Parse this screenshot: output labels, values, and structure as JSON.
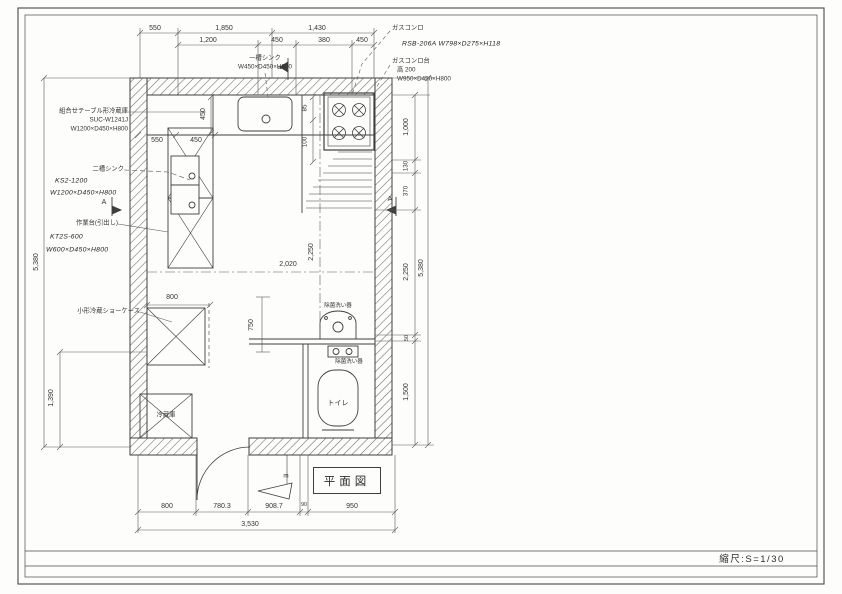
{
  "sheet": {
    "plan_title": "平面図",
    "scale_label": "縮尺:S=1/30"
  },
  "equipment": {
    "combo_fridge_table": {
      "name": "組合せテーブル形冷蔵庫",
      "model": "SUC-W1241J",
      "size": "W1200×D450×H800"
    },
    "single_sink": {
      "name": "一槽シンク",
      "size": "W450×D450×H800"
    },
    "gas_range": {
      "name": "ガスコンロ",
      "spec": "RSB-206A W798×D275×H118"
    },
    "gas_range_stand": {
      "name": "ガスコンロ台",
      "height_note": "高 200",
      "size": "W950×D450×H800"
    },
    "double_sink": {
      "name": "二槽シンク",
      "model": "KS2-1200",
      "size": "W1200×D450×H800"
    },
    "work_table": {
      "name": "作業台(引出し)",
      "model": "KT2S-600",
      "size": "W600×D450×H800"
    },
    "small_showcase": {
      "name": "小形冷蔵ショーケース"
    },
    "refrigerator": {
      "name": "冷蔵庫"
    },
    "sanitizer_upper": {
      "name": "除菌洗い器"
    },
    "sanitizer_lower": {
      "name": "除菌洗い器"
    },
    "toilet": {
      "name": "トイレ"
    }
  },
  "section_marks": {
    "top": "m",
    "bottom": "m",
    "left": "A",
    "right": "A"
  },
  "dimensions": {
    "top_row_overall": [
      "550",
      "1,850",
      "1,430"
    ],
    "top_row_detail": [
      "1,200",
      "450",
      "380",
      "450"
    ],
    "interior_top_widths": [
      "550",
      "450"
    ],
    "sink_depth": "450",
    "range_offsets": [
      "85",
      "100"
    ],
    "room_width": "2,020",
    "room_height": "2,250",
    "left_overall": "5,380",
    "left_lower": "1,390",
    "showcase_width": "800",
    "aisle_depth": "750",
    "right_segments": [
      "1,000",
      "130",
      "370",
      "2,250",
      "50",
      "1,500"
    ],
    "right_overall": "5,380",
    "bottom_segments": [
      "800",
      "780.3",
      "908.7",
      "90",
      "950"
    ],
    "bottom_overall": "3,530"
  },
  "colors": {
    "paper": "#fdfdfc",
    "wall_line": "#3f3f3f",
    "dim_line": "#5a5a5a",
    "text": "#2e2e2e"
  }
}
